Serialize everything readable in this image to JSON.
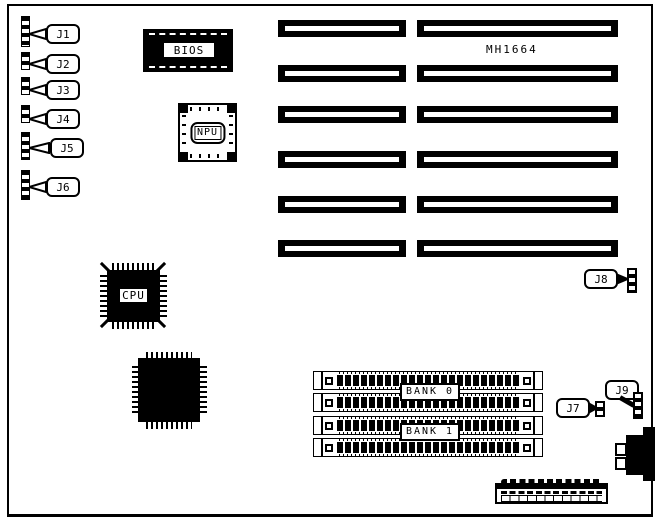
{
  "board": {
    "model_label": "MH1664",
    "left_connectors": [
      {
        "id": "J1"
      },
      {
        "id": "J2"
      },
      {
        "id": "J3"
      },
      {
        "id": "J4"
      },
      {
        "id": "J5"
      },
      {
        "id": "J6"
      }
    ],
    "right_connectors": [
      {
        "id": "J7"
      },
      {
        "id": "J8"
      },
      {
        "id": "J9"
      }
    ],
    "chips": {
      "bios": {
        "label": "BIOS"
      },
      "npu": {
        "label": "NPU"
      },
      "cpu": {
        "label": "CPU"
      }
    },
    "memory_banks": [
      {
        "label": "BANK 0"
      },
      {
        "label": "BANK 1"
      }
    ],
    "expansion_slots": {
      "left_column_count": 6,
      "right_column_count": 6
    },
    "colors": {
      "ink": "#000000",
      "paper": "#ffffff"
    }
  }
}
